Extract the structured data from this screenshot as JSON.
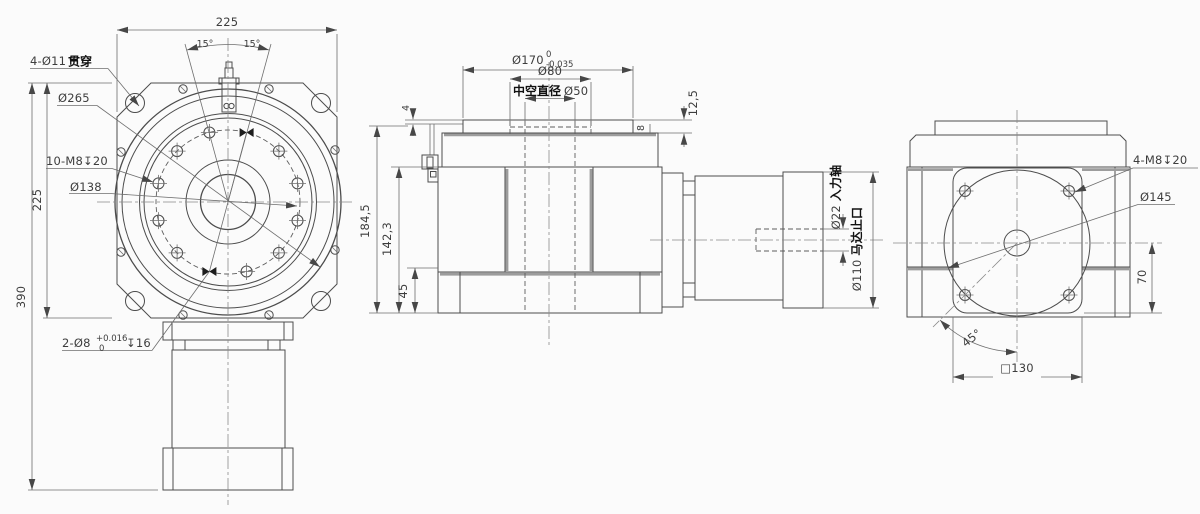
{
  "front_view": {
    "dim_width_top": "225",
    "angle_left": "15°",
    "angle_right": "15°",
    "label_corner_holes_prefix": "4-Ø11",
    "label_corner_holes_suffix": "贯穿",
    "label_outer_dia": "Ø265",
    "label_tapped_holes": "10-M8↧20",
    "label_bolt_circle_dia": "Ø138",
    "dim_plate_height": "225",
    "dim_total_height": "390",
    "label_dowel_holes": "2-Ø8",
    "dowel_tol_upper": "+0.016",
    "dowel_tol_lower": "0",
    "label_dowel_depth": "↧16"
  },
  "side_view": {
    "dim_output_flange_dia": "Ø170",
    "tol_upper": "0",
    "tol_lower": "-0.035",
    "dim_pilot_dia": "Ø80",
    "label_hollow_bore_cn": "中空直径",
    "label_hollow_bore_dia": "Ø50",
    "dim_flange_protrusion": "12,5",
    "dim_flange_thickness": "8",
    "dim_top_gap": "4",
    "dim_overall_height": "184,5",
    "dim_body_height": "142,3",
    "dim_base_height": "45",
    "label_input_shaft_dia": "Ø22 ",
    "label_input_shaft_cn": "入力轴",
    "label_motor_pilot_dia": "Ø110 ",
    "label_motor_pilot_cn": "马达止口"
  },
  "end_view": {
    "label_tapped_holes": "4-M8↧20",
    "label_bolt_circle_dia": "Ø145",
    "dim_center_to_base": "70",
    "angle_bolt": "45°",
    "dim_square_size": "□130"
  },
  "colors": {
    "line": "#4c4c4c",
    "thick_edge": "#9c9c9c",
    "background": "#fbfbfb",
    "dim_text": "#3d3d3d",
    "cjk_text": "#111111"
  }
}
